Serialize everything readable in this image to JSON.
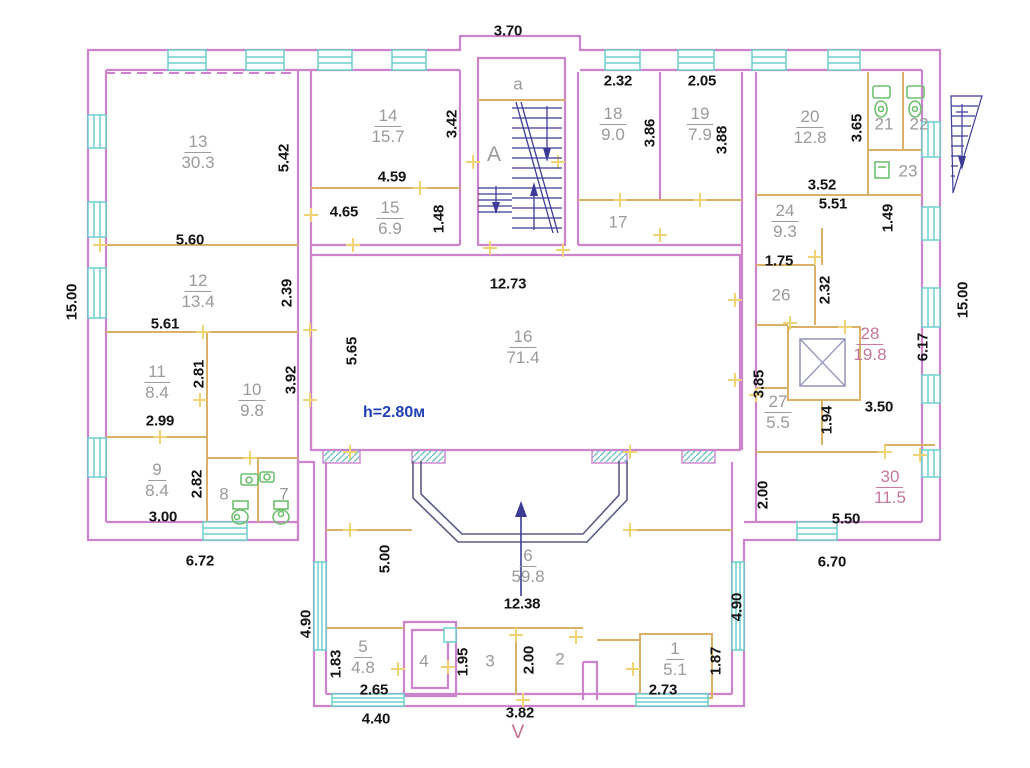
{
  "plan_type": "floor-plan",
  "rooms": {
    "r1": {
      "number": "1",
      "area": "5.1"
    },
    "r2": {
      "number": "2"
    },
    "r3": {
      "number": "3"
    },
    "r4": {
      "number": "4"
    },
    "r5": {
      "number": "5",
      "area": "4.8"
    },
    "r6": {
      "number": "6",
      "area": "59.8"
    },
    "r7": {
      "number": "7"
    },
    "r8": {
      "number": "8"
    },
    "r9": {
      "number": "9",
      "area": "8.4"
    },
    "r10": {
      "number": "10",
      "area": "9.8"
    },
    "r11": {
      "number": "11",
      "area": "8.4"
    },
    "r12": {
      "number": "12",
      "area": "13.4"
    },
    "r13": {
      "number": "13",
      "area": "30.3"
    },
    "r14": {
      "number": "14",
      "area": "15.7"
    },
    "r15": {
      "number": "15",
      "area": "6.9"
    },
    "r16": {
      "number": "16",
      "area": "71.4"
    },
    "r17": {
      "number": "17"
    },
    "r18": {
      "number": "18",
      "area": "9.0"
    },
    "r19": {
      "number": "19",
      "area": "7.9"
    },
    "r20": {
      "number": "20",
      "area": "12.8"
    },
    "r21": {
      "number": "21"
    },
    "r22": {
      "number": "22"
    },
    "r23": {
      "number": "23"
    },
    "r24": {
      "number": "24",
      "area": "9.3"
    },
    "r26": {
      "number": "26"
    },
    "r27": {
      "number": "27",
      "area": "5.5"
    },
    "r28": {
      "number": "28",
      "area": "19.8"
    },
    "r30": {
      "number": "30",
      "area": "11.5"
    }
  },
  "stairwell": {
    "upper_label": "a",
    "main_label": "A"
  },
  "dimensions": {
    "bump_width": "3.70",
    "r13_height": "5.42",
    "r13_width": "5.60",
    "r12_height": "2.39",
    "r12_width": "5.61",
    "r11_height": "2.81",
    "r11_width": "2.99",
    "r10_height": "3.92",
    "r9_height": "2.82",
    "r9_width": "3.00",
    "left_wing_height": "15.00",
    "left_wing_width": "6.72",
    "r14_height": "3.42",
    "r14_width": "4.59",
    "r15_width": "4.65",
    "r15_height": "1.48",
    "r18_width": "2.32",
    "r18_height": "3.86",
    "r19_width": "2.05",
    "r19_height": "3.88",
    "r20_height": "3.65",
    "r20_width": "3.52",
    "r24_width": "5.51",
    "r24_sub": "1.49",
    "r26_width": "1.75",
    "r26_height": "2.32",
    "right_wing_height": "15.00",
    "r16_width": "12.73",
    "r16_height": "5.65",
    "r27_height": "3.85",
    "r27_sub": "1.94",
    "r28_height": "6.17",
    "r28_width": "3.50",
    "r30_left": "2.00",
    "r30_width": "5.50",
    "right_wing_width": "6.70",
    "r6_height": "5.00",
    "r6_width": "12.38",
    "lower_left_height": "4.90",
    "lower_right_height": "4.90",
    "r5_height": "1.83",
    "r5_width": "2.65",
    "r5_outer": "4.40",
    "r3_height": "1.95",
    "r2_height": "2.00",
    "bottom_center": "3.82",
    "r1_width": "2.73",
    "r1_height": "1.87"
  },
  "annotations": {
    "ceiling_height": "h=2.80м",
    "section_mark": "V"
  },
  "colors": {
    "wall": "#cc85cc",
    "partition": "#d9b267",
    "window": "#6fcfcf",
    "stairs": "#3c3c96",
    "fixtures": "#6fbf6f",
    "room_label": "#9a9a9a",
    "room_label_accent": "#c4789c",
    "dimension": "#141414",
    "height_note": "#2040b8",
    "door_tick": "#f0d473"
  }
}
